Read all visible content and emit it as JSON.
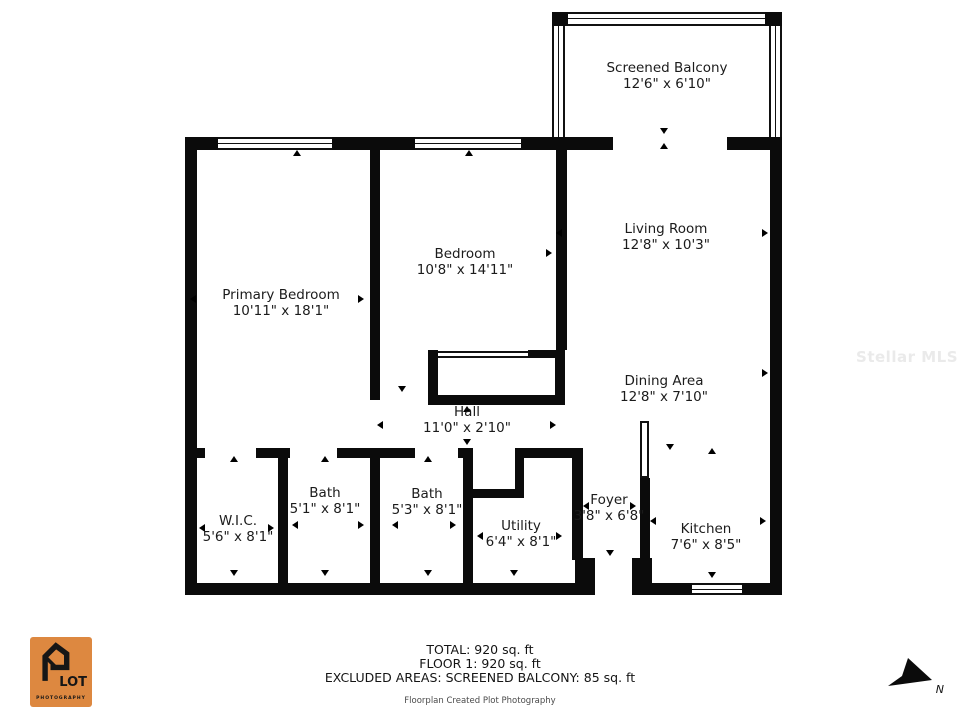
{
  "watermark": "Stellar MLS",
  "rooms": {
    "balcony": {
      "name": "Screened Balcony",
      "dims": "12'6\" x 6'10\""
    },
    "living": {
      "name": "Living Room",
      "dims": "12'8\" x 10'3\""
    },
    "bedroom": {
      "name": "Bedroom",
      "dims": "10'8\" x 14'11\""
    },
    "primary": {
      "name": "Primary Bedroom",
      "dims": "10'11\" x 18'1\""
    },
    "dining": {
      "name": "Dining Area",
      "dims": "12'8\" x 7'10\""
    },
    "hall": {
      "name": "Hall",
      "dims": "11'0\" x 2'10\""
    },
    "wic": {
      "name": "W.I.C.",
      "dims": "5'6\" x 8'1\""
    },
    "bath1": {
      "name": "Bath",
      "dims": "5'1\" x 8'1\""
    },
    "bath2": {
      "name": "Bath",
      "dims": "5'3\" x 8'1\""
    },
    "utility": {
      "name": "Utility",
      "dims": "6'4\" x 8'1\""
    },
    "foyer": {
      "name": "Foyer",
      "dims": "3'8\" x 6'8\""
    },
    "kitchen": {
      "name": "Kitchen",
      "dims": "7'6\" x 8'5\""
    }
  },
  "footer": {
    "total": "TOTAL: 920 sq. ft",
    "floor": "FLOOR 1: 920 sq. ft",
    "excluded": "EXCLUDED AREAS: SCREENED BALCONY: 85 sq. ft",
    "credit": "Floorplan Created Plot Photography"
  },
  "logo": {
    "line1": "LOT",
    "line2": "PHOTOGRAPHY",
    "accent_color": "#DD8840"
  },
  "compass": {
    "label": "N"
  }
}
